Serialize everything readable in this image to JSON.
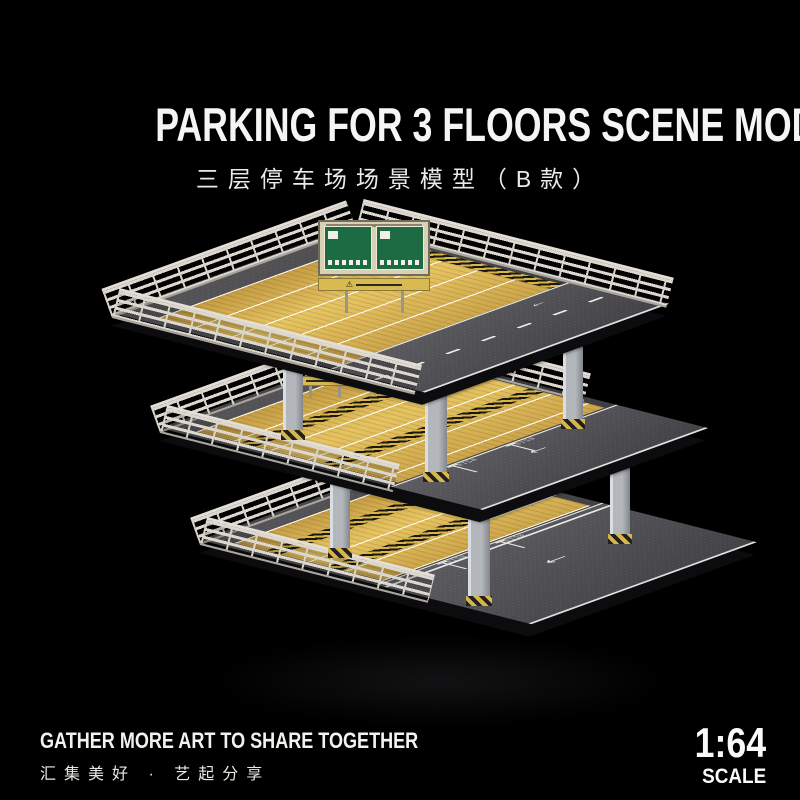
{
  "header": {
    "title": "PARKING FOR 3 FLOORS SCENE MODEL （SECTION B）",
    "subtitle_cn": "三层停车场场景模型（B款）"
  },
  "scene": {
    "arrow": "←",
    "warning_icon": "⚠",
    "stall_number": "6129",
    "colors": {
      "background": "#000000",
      "asphalt": "#47474b",
      "wood_deck": "#e6c462",
      "slab_edge": "#0c0c0e",
      "railing": "#d7d3ca",
      "pillar": "#b3b7bc",
      "hazard_yellow": "#d9b549",
      "hazard_black": "#18180f",
      "road_marking": "#e9e9e5",
      "sign_green": "#1d6b43",
      "sign_board": "#d8d1b6",
      "warning_strip": "#d9ba50"
    }
  },
  "footer": {
    "slogan_en": "GATHER MORE ART TO SHARE TOGETHER",
    "slogan_cn": "汇集美好 · 艺起分享",
    "scale_value": "1:64",
    "scale_label": "SCALE"
  }
}
